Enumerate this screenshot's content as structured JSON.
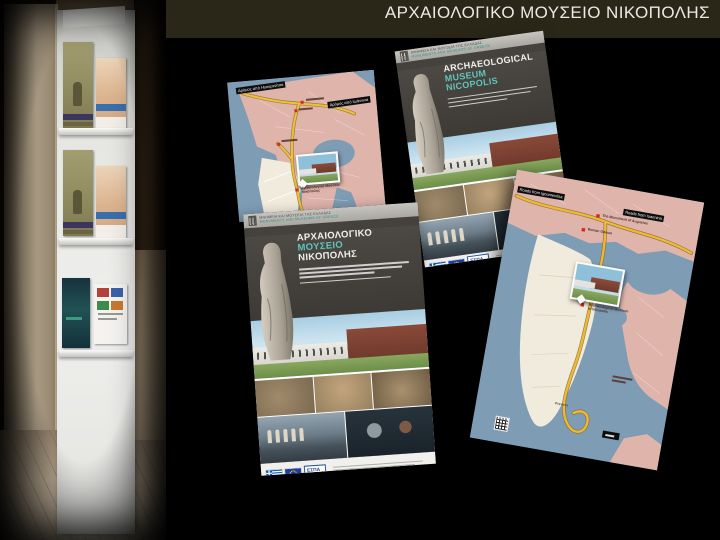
{
  "slide": {
    "title": "ΑΡΧΑΙΟΛΟΓΙΚΟ ΜΟΥΣΕΙΟ ΝΙΚΟΠΟΛΗΣ"
  },
  "colors": {
    "background": "#000000",
    "titlebar": "#2b2718",
    "title_text": "#eae9e4",
    "accent_teal": "#2e8f8a",
    "map_sea": "#7e9cb4",
    "map_land_pink": "#dfb4ab",
    "map_peninsula": "#f0ebdc",
    "map_road_yellow": "#ecb93a",
    "cover_charcoal": "#45423d",
    "marker_red": "#d12c20"
  },
  "map_gr": {
    "road_label_left": "Δρόμος από Ηγουμενίτσα",
    "road_label_right": "Δρόμος από Ιωάννινα",
    "museum_label_1": "Αρχαιολογικό Μουσείο",
    "museum_label_2": "Νικόπολης"
  },
  "cover_gr": {
    "series_line1": "ΜΝΗΜΕΙΑ ΚΑΙ ΜΟΥΣΕΙΑ ΤΗΣ ΕΛΛΑΔΑΣ",
    "series_line2": "MONUMENTS AND MUSEUMS OF GREECE",
    "title_line1": "ΑΡΧΑΙΟΛΟΓΙΚΟ",
    "title_line2": "ΜΟΥΣΕΙΟ",
    "title_line3": "ΝΙΚΟΠΟΛΗΣ",
    "espa_label": "ΕΣΠΑ"
  },
  "cover_en": {
    "series_line1": "ΜΝΗΜΕΙΑ ΚΑΙ ΜΟΥΣΕΙΑ ΤΗΣ ΕΛΛΑΔΑΣ",
    "series_line2": "MONUMENTS AND MUSEUMS OF GREECE",
    "title_line1": "ARCHAEOLOGICAL",
    "title_line2": "MUSEUM",
    "title_line3": "NICOPOLIS",
    "espa_label": "ΕΣΠΑ"
  },
  "map_en": {
    "road_label_left": "Roads from Igoumenitsa",
    "road_label_right": "Roads from Ioannina",
    "site_label_1": "The Monument of Augustus",
    "site_label_2": "Roman Odeum",
    "museum_label_1": "Archaeological Museum",
    "museum_label_2": "of Nicopolis",
    "town_label": "Preveza"
  }
}
